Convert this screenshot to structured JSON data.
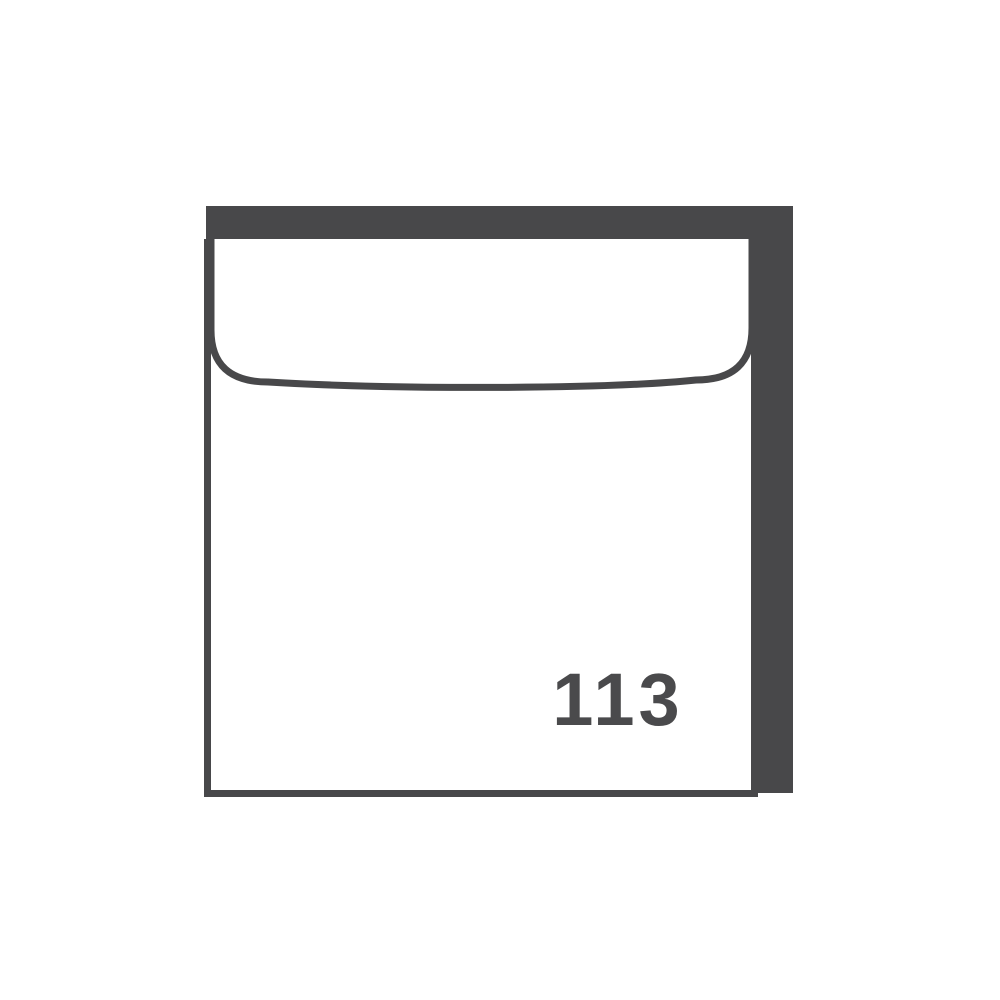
{
  "page": {
    "background_color": "#ffffff"
  },
  "envelope": {
    "number_label": "113",
    "colors": {
      "line": "#48484a",
      "paper": "#ffffff",
      "text": "#4a4a4c"
    }
  }
}
